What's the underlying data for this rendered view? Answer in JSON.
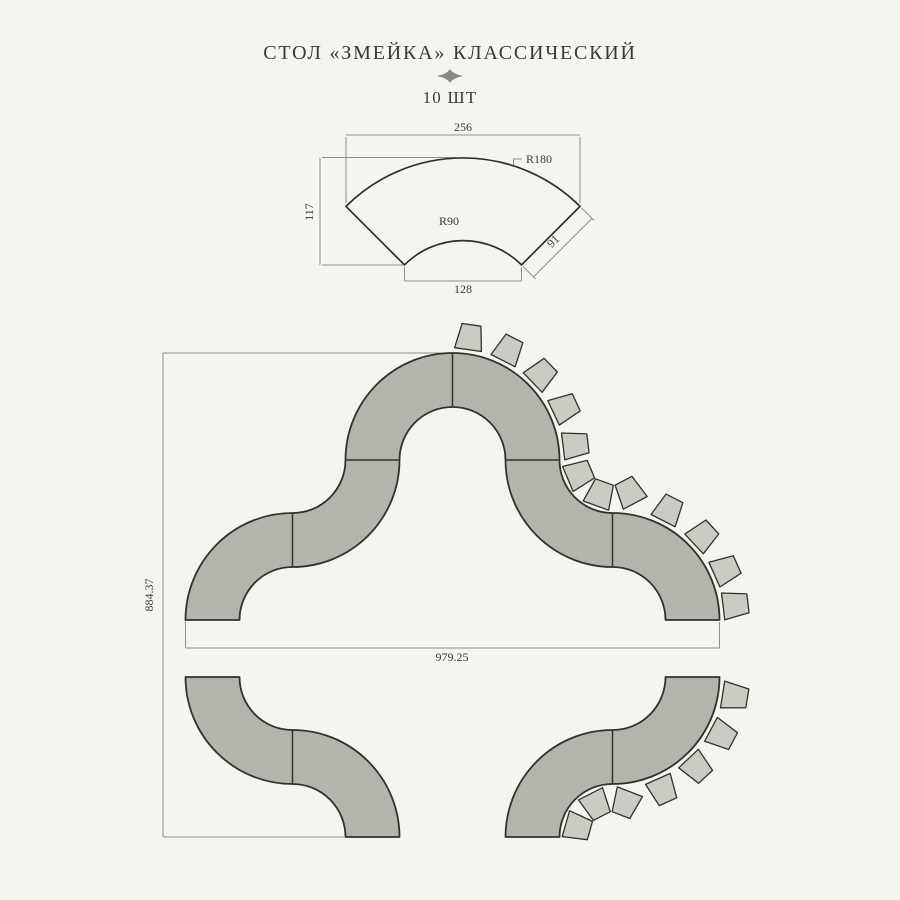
{
  "title": "СТОЛ «ЗМЕЙКА» КЛАССИЧЕСКИЙ",
  "quantity": "10 ШТ",
  "part_drawing": {
    "dim_outer_chord": "256",
    "dim_outer_radius": "R180",
    "dim_height": "117",
    "dim_inner_radius": "R90",
    "dim_end_width": "91",
    "dim_inner_chord": "128"
  },
  "layout_drawing": {
    "dim_width": "979.25",
    "dim_height": "884.37",
    "upper_row_segments": 6,
    "lower_left_segments": 2,
    "lower_right_segments": 2,
    "chairs_total": 19,
    "chair_groups": [
      {
        "name": "upper-arch-outer",
        "cx": 452.5,
        "cy": 460,
        "radius": 124,
        "facing": "in",
        "angles_deg": [
          -82,
          -63,
          -44,
          -25,
          -7
        ]
      },
      {
        "name": "upper-right-notch",
        "cx": 612.5,
        "cy": 460,
        "radius": 36,
        "facing": "out",
        "angles_deg": [
          157,
          110,
          62
        ]
      },
      {
        "name": "upper-right-outer",
        "cx": 612.5,
        "cy": 620,
        "radius": 124,
        "facing": "in",
        "angles_deg": [
          -63,
          -43,
          -24,
          -7
        ]
      },
      {
        "name": "lower-right-outer",
        "cx": 612.5,
        "cy": 677,
        "radius": 124,
        "facing": "in",
        "angles_deg": [
          9,
          28,
          47,
          66
        ]
      },
      {
        "name": "lower-right-notch",
        "cx": 612.5,
        "cy": 837,
        "radius": 36,
        "facing": "out",
        "angles_deg": [
          -69,
          -117,
          -164
        ]
      }
    ]
  },
  "colors": {
    "background": "#f4f4f1",
    "table_fill": "#b3b4ac",
    "chair_fill": "#cacbc3",
    "outline": "#32322b",
    "dim_line": "#8f8f88",
    "text": "#3b3b32"
  }
}
